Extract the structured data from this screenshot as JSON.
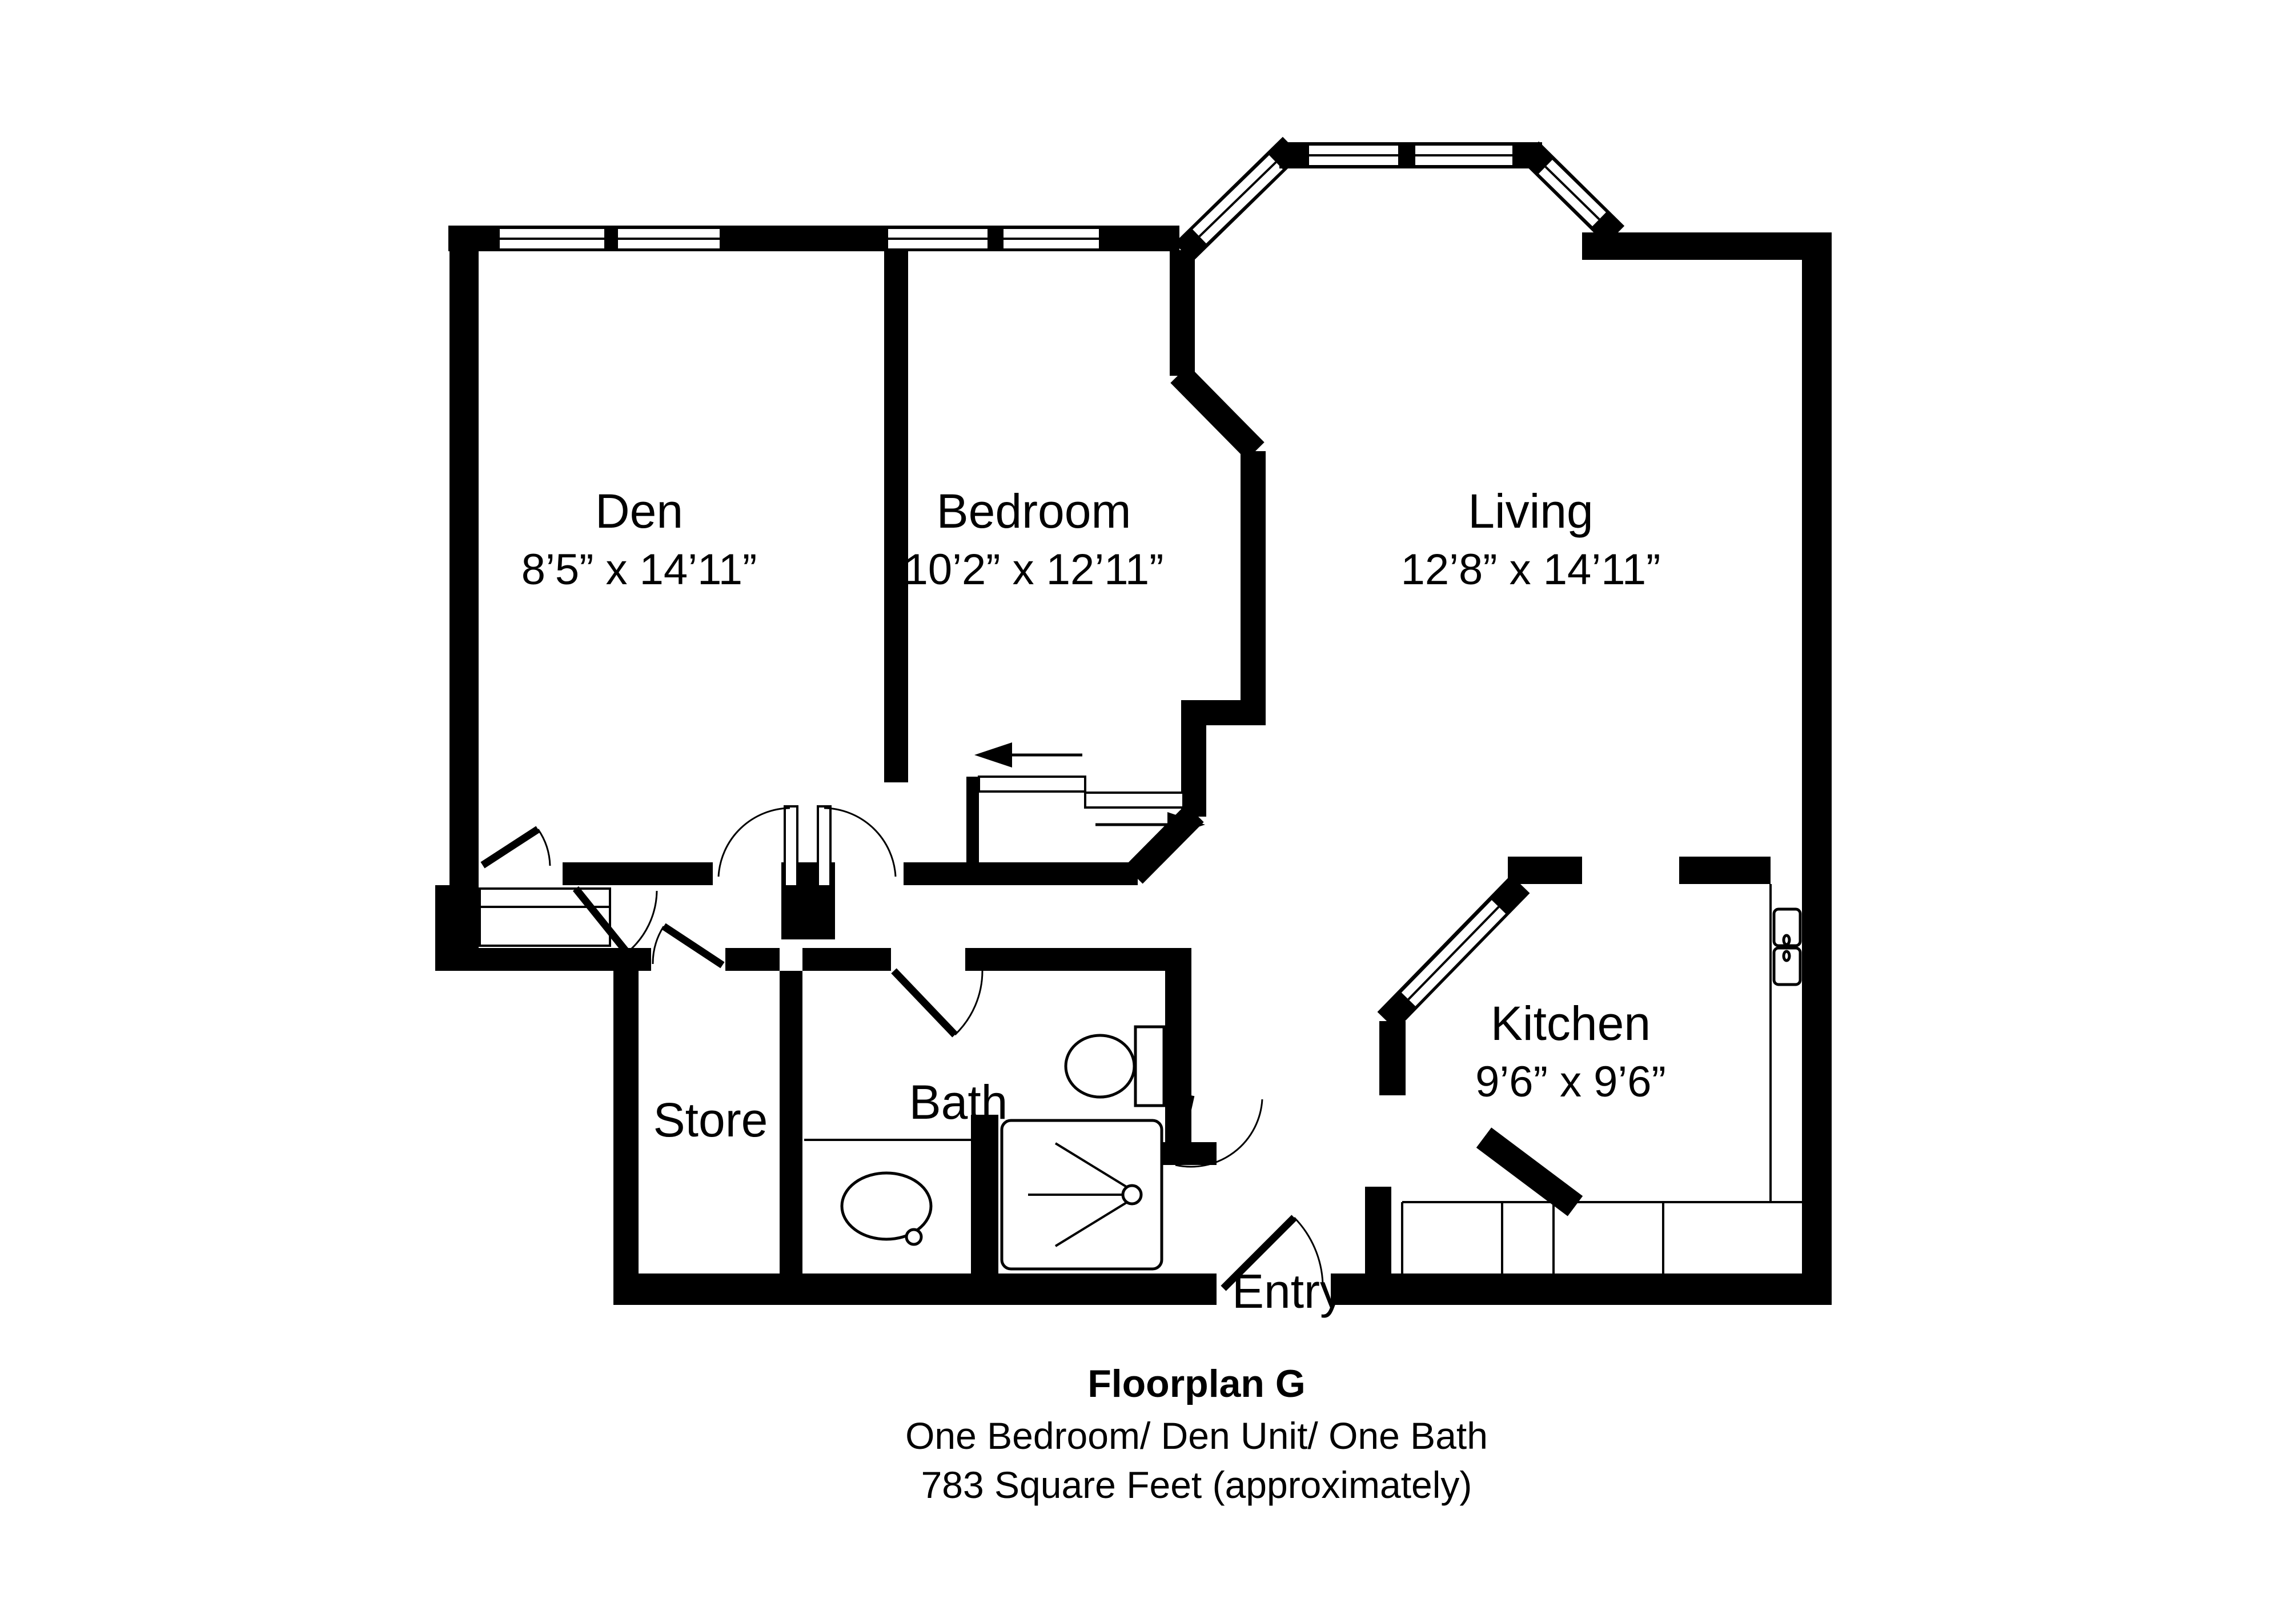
{
  "colors": {
    "background": "#ffffff",
    "wall": "#000000",
    "text": "#000000"
  },
  "rooms": [
    {
      "id": "den",
      "name": "Den",
      "dimensions": "8’5” x 14’11”"
    },
    {
      "id": "bedroom",
      "name": "Bedroom",
      "dimensions": "10’2” x 12’11”"
    },
    {
      "id": "living",
      "name": "Living",
      "dimensions": "12’8” x 14’11”"
    },
    {
      "id": "kitchen",
      "name": "Kitchen",
      "dimensions": "9’6” x 9’6”"
    },
    {
      "id": "store",
      "name": "Store"
    },
    {
      "id": "bath",
      "name": "Bath"
    },
    {
      "id": "entry",
      "name": "Entry"
    }
  ],
  "caption": {
    "title": "Floorplan G",
    "line2": "One Bedroom/ Den Unit/ One Bath",
    "line3": "783 Square Feet (approximately)"
  },
  "fixtures": {
    "bay_window": "bay-window",
    "sliding_door": "bypass-sliding-door",
    "toilet": "toilet",
    "vanity_sink": "vanity-sink",
    "shower": "shower",
    "kitchen_sink": "double-kitchen-sink",
    "kitchen_cabinets": "kitchen-cabinets",
    "closet": "den-closet"
  }
}
